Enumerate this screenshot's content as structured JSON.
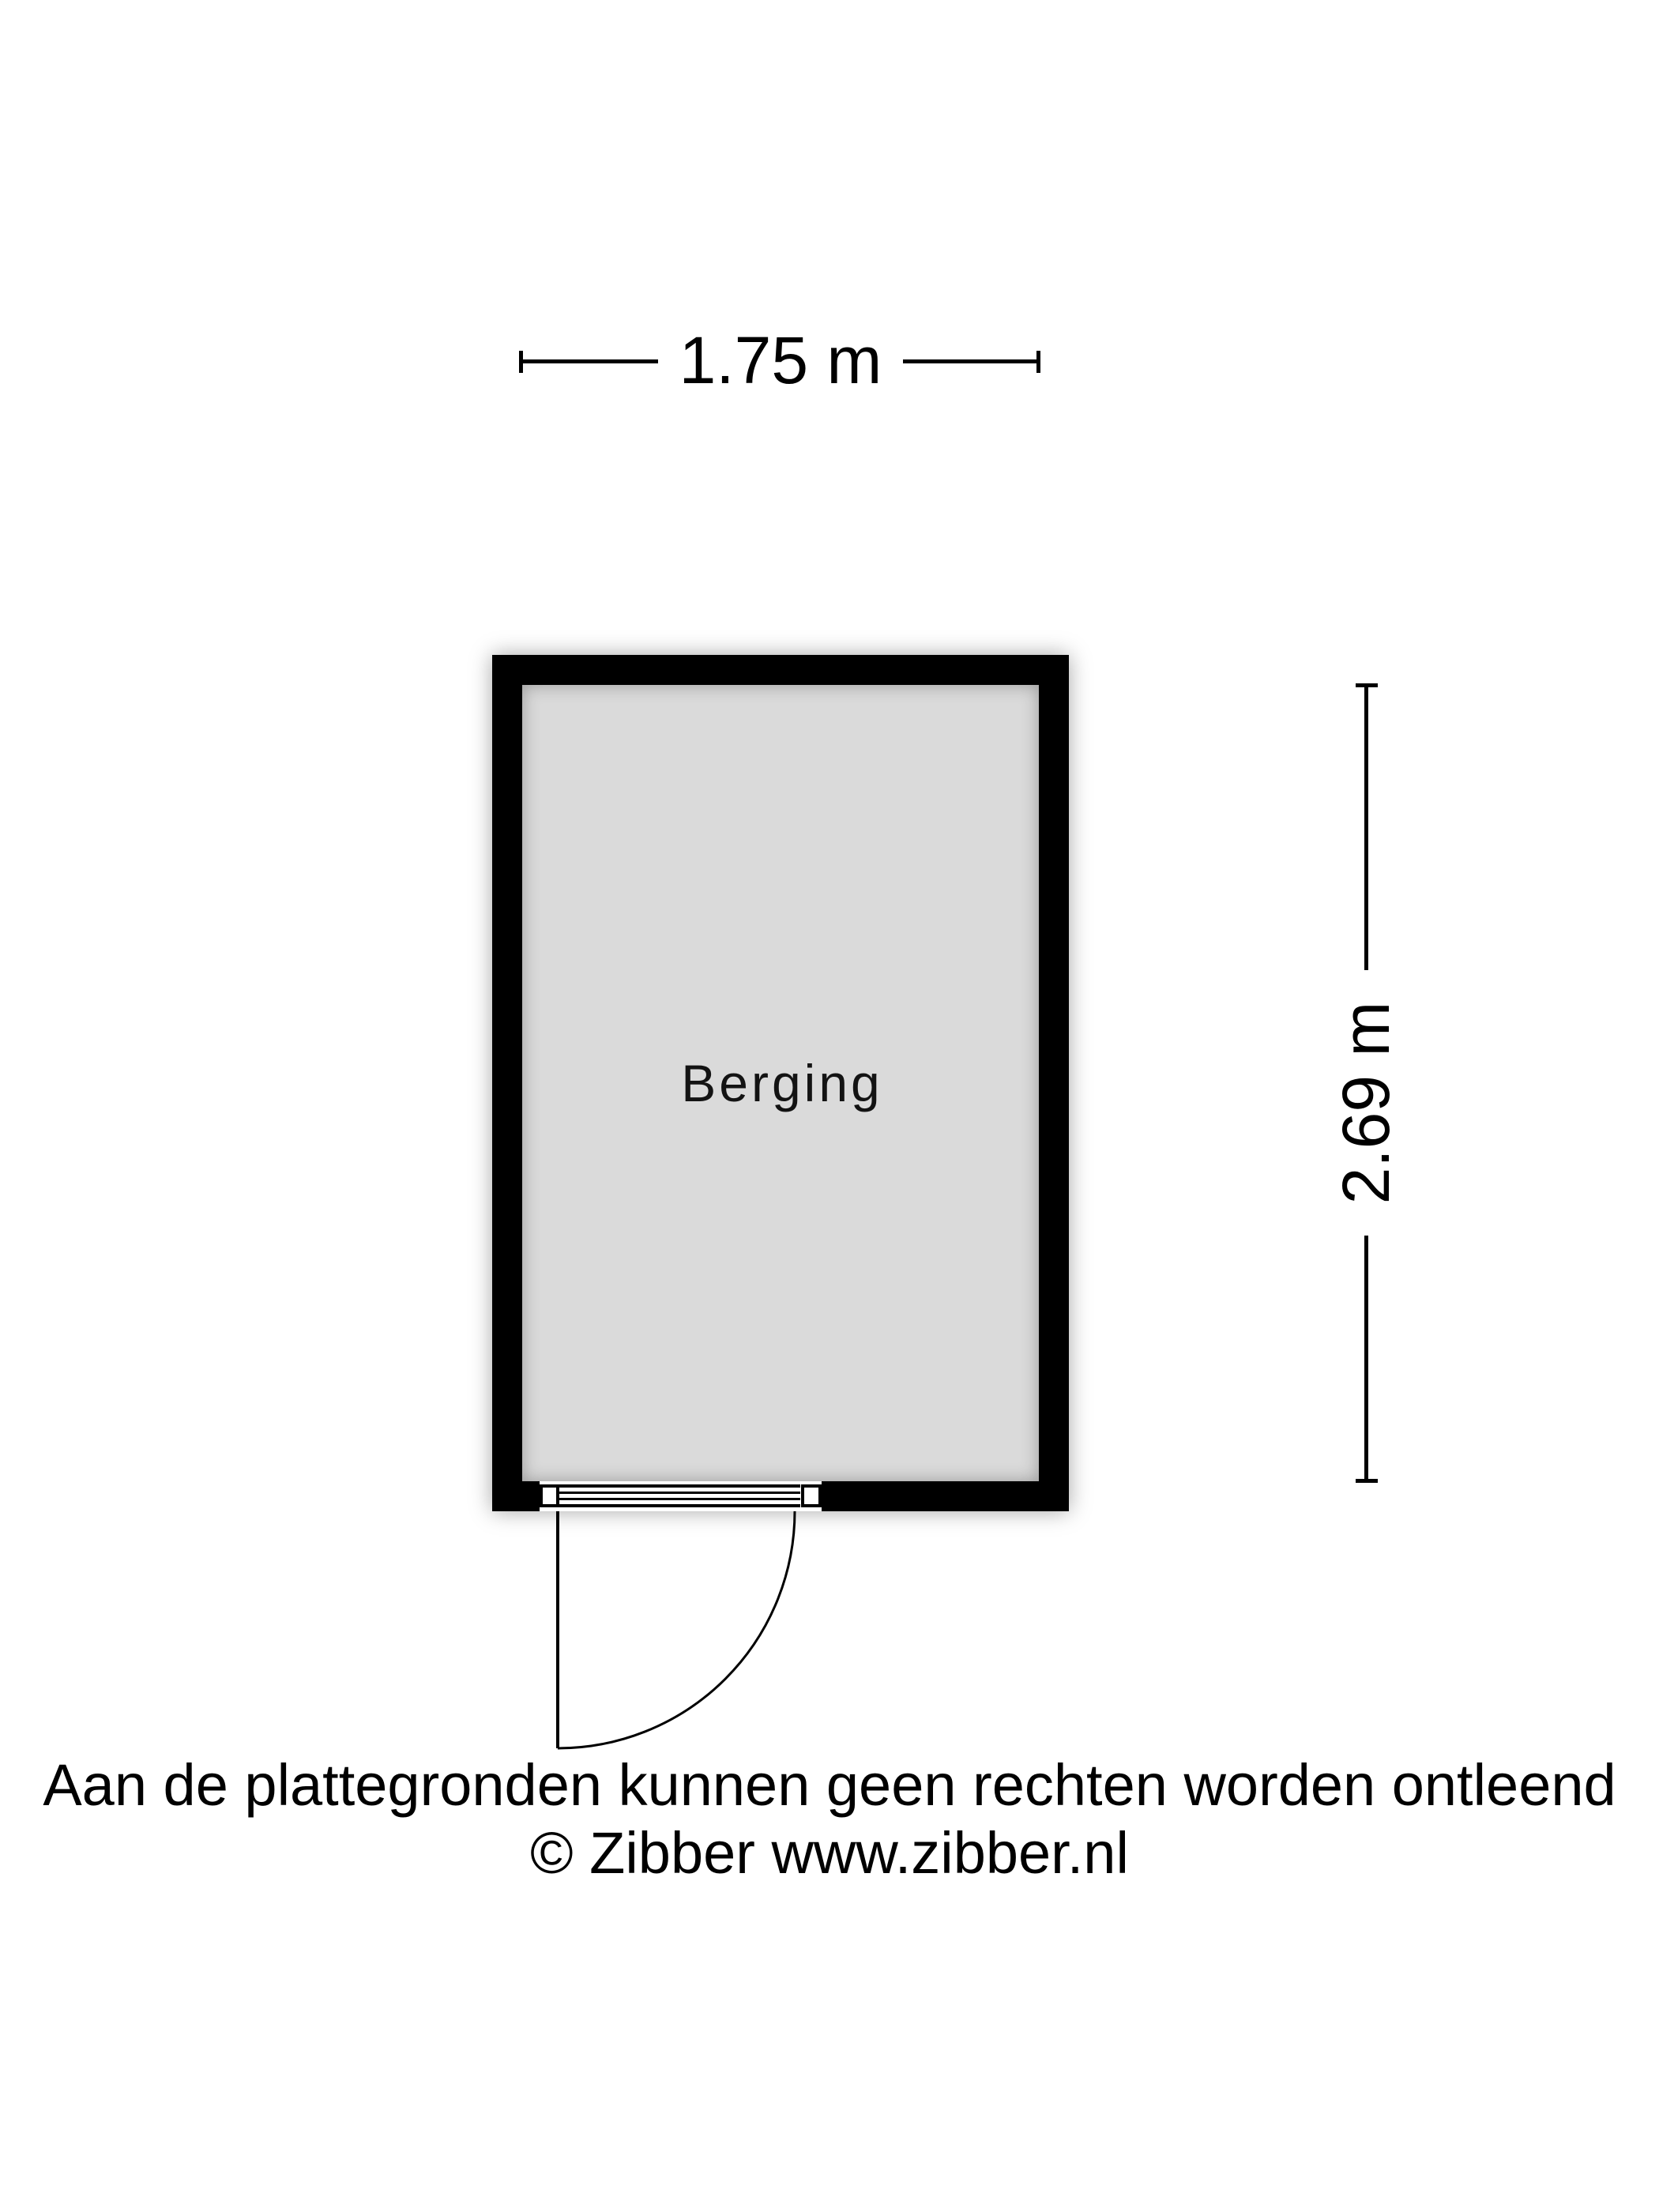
{
  "floorplan": {
    "room": {
      "label": "Berging"
    },
    "dimensions": {
      "width": {
        "label": "1.75 m"
      },
      "height": {
        "label": "2.69 m"
      }
    },
    "door": {
      "icon": "swing-door-quarter-arc"
    }
  },
  "footer": {
    "disclaimer": "Aan de plattegronden kunnen geen rechten worden ontleend",
    "copyright": "© Zibber www.zibber.nl"
  },
  "colors": {
    "wall": "#000000",
    "room_fill": "#dadada",
    "background": "#ffffff",
    "text": "#000000"
  }
}
